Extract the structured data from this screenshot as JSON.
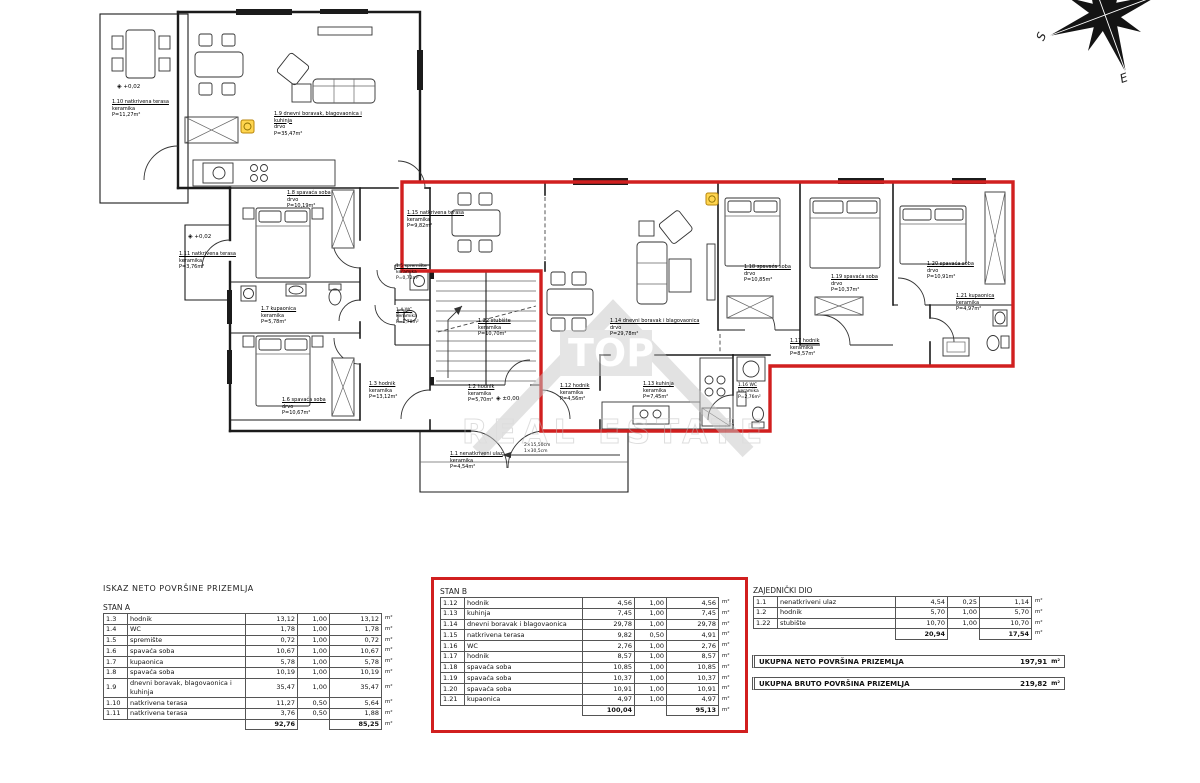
{
  "plan": {
    "rooms": {
      "r1_10": {
        "title": "1.10 natkrivena terasa",
        "mat": "keramika",
        "area": "P=11,27m²"
      },
      "r1_9": {
        "title": "1.9 dnevni boravak, blagovaonica i kuhinja",
        "mat": "drvo",
        "area": "P=35,47m²"
      },
      "r1_8": {
        "title": "1.8 spavaća soba",
        "mat": "drvo",
        "area": "P=10,19m²"
      },
      "r1_11": {
        "title": "1.11 natkrivena terasa",
        "mat": "keramika",
        "area": "P=3,76m²"
      },
      "r1_7": {
        "title": "1.7 kupaonica",
        "mat": "keramika",
        "area": "P=5,78m²"
      },
      "r1_6": {
        "title": "1.6 spavaća soba",
        "mat": "drvo",
        "area": "P=10,67m²"
      },
      "r1_3": {
        "title": "1.3 hodnik",
        "mat": "keramika",
        "area": "P=13,12m²"
      },
      "r1_5": {
        "title": "1.5 spremište",
        "mat": "keramika",
        "area": "P=0,72m²"
      },
      "r1_4": {
        "title": "1.4 WC",
        "mat": "keramika",
        "area": "P=1,78m²"
      },
      "r1_22": {
        "title": "1.22 stubište",
        "mat": "keramika",
        "area": "P=10,70m²"
      },
      "r1_2": {
        "title": "1.2 hodnik",
        "mat": "keramika",
        "area": "P=5,70m²"
      },
      "r1_1": {
        "title": "1.1 nenatkriveni ulaz",
        "mat": "keramika",
        "area": "P=4,54m²"
      },
      "r1_15": {
        "title": "1.15 natkrivena terasa",
        "mat": "keramika",
        "area": "P=9,82m²"
      },
      "r1_14": {
        "title": "1.14 dnevni boravak i blagovaonica",
        "mat": "drvo",
        "area": "P=29,78m²"
      },
      "r1_12": {
        "title": "1.12 hodnik",
        "mat": "keramika",
        "area": "P=4,56m²"
      },
      "r1_13": {
        "title": "1.13 kuhinja",
        "mat": "keramika",
        "area": "P=7,45m²"
      },
      "r1_16": {
        "title": "1.16 WC",
        "mat": "keramika",
        "area": "P=2,76m²"
      },
      "r1_17": {
        "title": "1.17 hodnik",
        "mat": "keramika",
        "area": "P=8,57m²"
      },
      "r1_18": {
        "title": "1.18 spavaća soba",
        "mat": "drvo",
        "area": "P=10,85m²"
      },
      "r1_19": {
        "title": "1.19 spavaća soba",
        "mat": "drvo",
        "area": "P=10,37m²"
      },
      "r1_20": {
        "title": "1.20 spavaća soba",
        "mat": "drvo",
        "area": "P=10,91m²"
      },
      "r1_21": {
        "title": "1.21 kupaonica",
        "mat": "keramika",
        "area": "P=4,97m²"
      }
    },
    "elevations": {
      "terrace": "+0,02",
      "side": "+0,02",
      "entry": "±0,00",
      "symbol": "◈"
    },
    "dimension": {
      "line1": "2×15,50cm",
      "line2": "1×30,5cm"
    },
    "compass": {
      "s": "S",
      "e": "E"
    },
    "watermark": {
      "brand": "TOP",
      "text": "REAL ESTATE"
    },
    "accent_red": "#d11f1f"
  },
  "tables": {
    "main_title": "ISKAZ NETO POVRŠINE PRIZEMLJA",
    "stanA": {
      "title": "STAN A",
      "rows": [
        {
          "id": "1.3",
          "name": "hodnik",
          "a": "13,12",
          "k": "1,00",
          "r": "13,12",
          "u": "m²"
        },
        {
          "id": "1.4",
          "name": "WC",
          "a": "1,78",
          "k": "1,00",
          "r": "1,78",
          "u": "m²"
        },
        {
          "id": "1.5",
          "name": "spremište",
          "a": "0,72",
          "k": "1,00",
          "r": "0,72",
          "u": "m²"
        },
        {
          "id": "1.6",
          "name": "spavaća soba",
          "a": "10,67",
          "k": "1,00",
          "r": "10,67",
          "u": "m²"
        },
        {
          "id": "1.7",
          "name": "kupaonica",
          "a": "5,78",
          "k": "1,00",
          "r": "5,78",
          "u": "m²"
        },
        {
          "id": "1.8",
          "name": "spavaća soba",
          "a": "10,19",
          "k": "1,00",
          "r": "10,19",
          "u": "m²"
        },
        {
          "id": "1.9",
          "name": "dnevni boravak, blagovaonica i kuhinja",
          "a": "35,47",
          "k": "1,00",
          "r": "35,47",
          "u": "m²"
        },
        {
          "id": "1.10",
          "name": "natkrivena terasa",
          "a": "11,27",
          "k": "0,50",
          "r": "5,64",
          "u": "m²"
        },
        {
          "id": "1.11",
          "name": "natkrivena terasa",
          "a": "3,76",
          "k": "0,50",
          "r": "1,88",
          "u": "m²"
        }
      ],
      "total_a": "92,76",
      "total_r": "85,25",
      "unit": "m²"
    },
    "stanB": {
      "title": "STAN B",
      "rows": [
        {
          "id": "1.12",
          "name": "hodnik",
          "a": "4,56",
          "k": "1,00",
          "r": "4,56",
          "u": "m²"
        },
        {
          "id": "1.13",
          "name": "kuhinja",
          "a": "7,45",
          "k": "1,00",
          "r": "7,45",
          "u": "m²"
        },
        {
          "id": "1.14",
          "name": "dnevni boravak i blagovaonica",
          "a": "29,78",
          "k": "1,00",
          "r": "29,78",
          "u": "m²"
        },
        {
          "id": "1.15",
          "name": "natkrivena terasa",
          "a": "9,82",
          "k": "0,50",
          "r": "4,91",
          "u": "m²"
        },
        {
          "id": "1.16",
          "name": "WC",
          "a": "2,76",
          "k": "1,00",
          "r": "2,76",
          "u": "m²"
        },
        {
          "id": "1.17",
          "name": "hodnik",
          "a": "8,57",
          "k": "1,00",
          "r": "8,57",
          "u": "m²"
        },
        {
          "id": "1.18",
          "name": "spavaća soba",
          "a": "10,85",
          "k": "1,00",
          "r": "10,85",
          "u": "m²"
        },
        {
          "id": "1.19",
          "name": "spavaća soba",
          "a": "10,37",
          "k": "1,00",
          "r": "10,37",
          "u": "m²"
        },
        {
          "id": "1.20",
          "name": "spavaća soba",
          "a": "10,91",
          "k": "1,00",
          "r": "10,91",
          "u": "m²"
        },
        {
          "id": "1.21",
          "name": "kupaonica",
          "a": "4,97",
          "k": "1,00",
          "r": "4,97",
          "u": "m²"
        }
      ],
      "total_a": "100,04",
      "total_r": "95,13",
      "unit": "m²"
    },
    "common": {
      "title": "ZAJEDNIČKI DIO",
      "rows": [
        {
          "id": "1.1",
          "name": "nenatkriveni ulaz",
          "a": "4,54",
          "k": "0,25",
          "r": "1,14",
          "u": "m²"
        },
        {
          "id": "1.2",
          "name": "hodnik",
          "a": "5,70",
          "k": "1,00",
          "r": "5,70",
          "u": "m²"
        },
        {
          "id": "1.22",
          "name": "stubište",
          "a": "10,70",
          "k": "1,00",
          "r": "10,70",
          "u": "m²"
        }
      ],
      "total_a": "20,94",
      "total_r": "17,54",
      "unit": "m²"
    },
    "summary": [
      {
        "label": "UKUPNA NETO POVRŠINA PRIZEMLJA",
        "value": "197,91",
        "unit": "m²"
      },
      {
        "label": "UKUPNA BRUTO POVRŠINA PRIZEMLJA",
        "value": "219,82",
        "unit": "m²"
      }
    ]
  }
}
